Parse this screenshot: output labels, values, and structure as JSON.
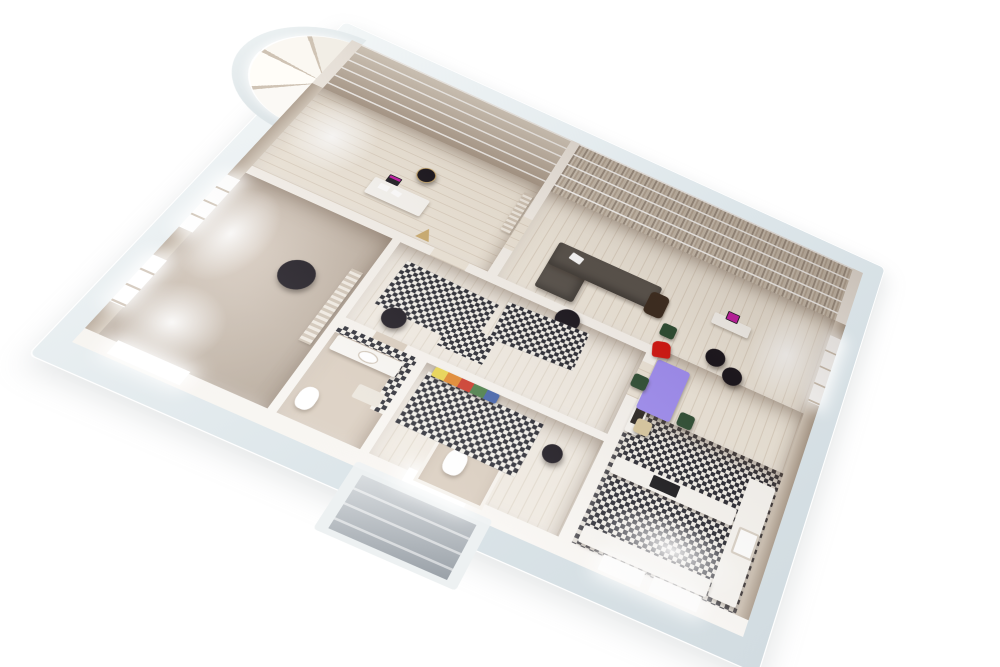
{
  "meta": {
    "title": "3D apartment floor plan render",
    "style": "photorealistic architectural cutaway, perspective bird's-eye view, plan rotated about 25 degrees",
    "background": "#ffffff",
    "no_visible_text": true
  },
  "palette": {
    "slab": "#e3eaed",
    "wall": "#f6f2ec",
    "wood": "#e7dcce",
    "whitewash": "#ece5d9",
    "carpet": "#c9bcae",
    "checker_dark": "#23242d",
    "checker_light": "#f2efe8",
    "entry_gray": "#a8aeb5",
    "sofa": "#56504a",
    "pouf_black": "#16121a",
    "dining_table": "#9d8bf0",
    "chair_red": "#d0140f",
    "chair_green": "#2b4b31",
    "chair_beige": "#d8c79e",
    "armchair_brown": "#39291d",
    "laptop_screen": "#c018a2",
    "tv_black": "#26221f",
    "cooktop": "#141417",
    "easel_wood": "#c9a96c",
    "rainbow": [
      "#e9d44b",
      "#e08327",
      "#cb3526",
      "#477c45",
      "#3f5fa8"
    ]
  },
  "rooms": {
    "office": {
      "name": "Studio / home office with curved bay window",
      "floor": "light wood planks",
      "items": [
        "arched bay windows",
        "white desk",
        "laptop",
        "black chair",
        "wooden easel",
        "wall shelving"
      ]
    },
    "living_room": {
      "name": "Living room",
      "floor": "light wood planks",
      "items": [
        "wall-length bookshelves",
        "L-shaped taupe sofa",
        "white throw",
        "black pouf",
        "brown armchair",
        "media unit with TV",
        "sideboard with magenta laptop",
        "green side chair"
      ]
    },
    "dining_area": {
      "name": "Dining area",
      "floor": "light wood planks",
      "items": [
        "purple dining table",
        "red chair",
        "three green chairs",
        "beige chair",
        "black pouf"
      ]
    },
    "kitchen": {
      "name": "Kitchen",
      "floor": "black and white checker tile",
      "items": [
        "white peninsula counter",
        "black cooktop",
        "white counter with sink",
        "two windows"
      ]
    },
    "hallway": {
      "name": "Hallway",
      "floor": "whitewashed wood with checker runners",
      "items": [
        "checker runner rugs",
        "black pouf"
      ]
    },
    "bedroom": {
      "name": "Bedroom",
      "floor": "taupe carpet",
      "items": [
        "two tall side windows",
        "lower wall window",
        "round black rug",
        "wall shelf unit"
      ]
    },
    "kids_room": {
      "name": "Second bedroom",
      "floor": "whitewashed wood",
      "items": [
        "large checker rug",
        "rainbow striped bench",
        "black pouf"
      ]
    },
    "bathroom": {
      "name": "Bathroom",
      "floor": "beige screed with checker tile accents",
      "items": [
        "vanity with basin",
        "toilet",
        "bath mat",
        "checker tiled wall bands"
      ]
    },
    "wc": {
      "name": "WC",
      "floor": "beige screed",
      "items": [
        "toilet",
        "checker tiled wall band"
      ]
    },
    "entry": {
      "name": "Entrance landing",
      "floor": "gray stone steps",
      "items": [
        "white entry door",
        "stair landing"
      ]
    }
  }
}
